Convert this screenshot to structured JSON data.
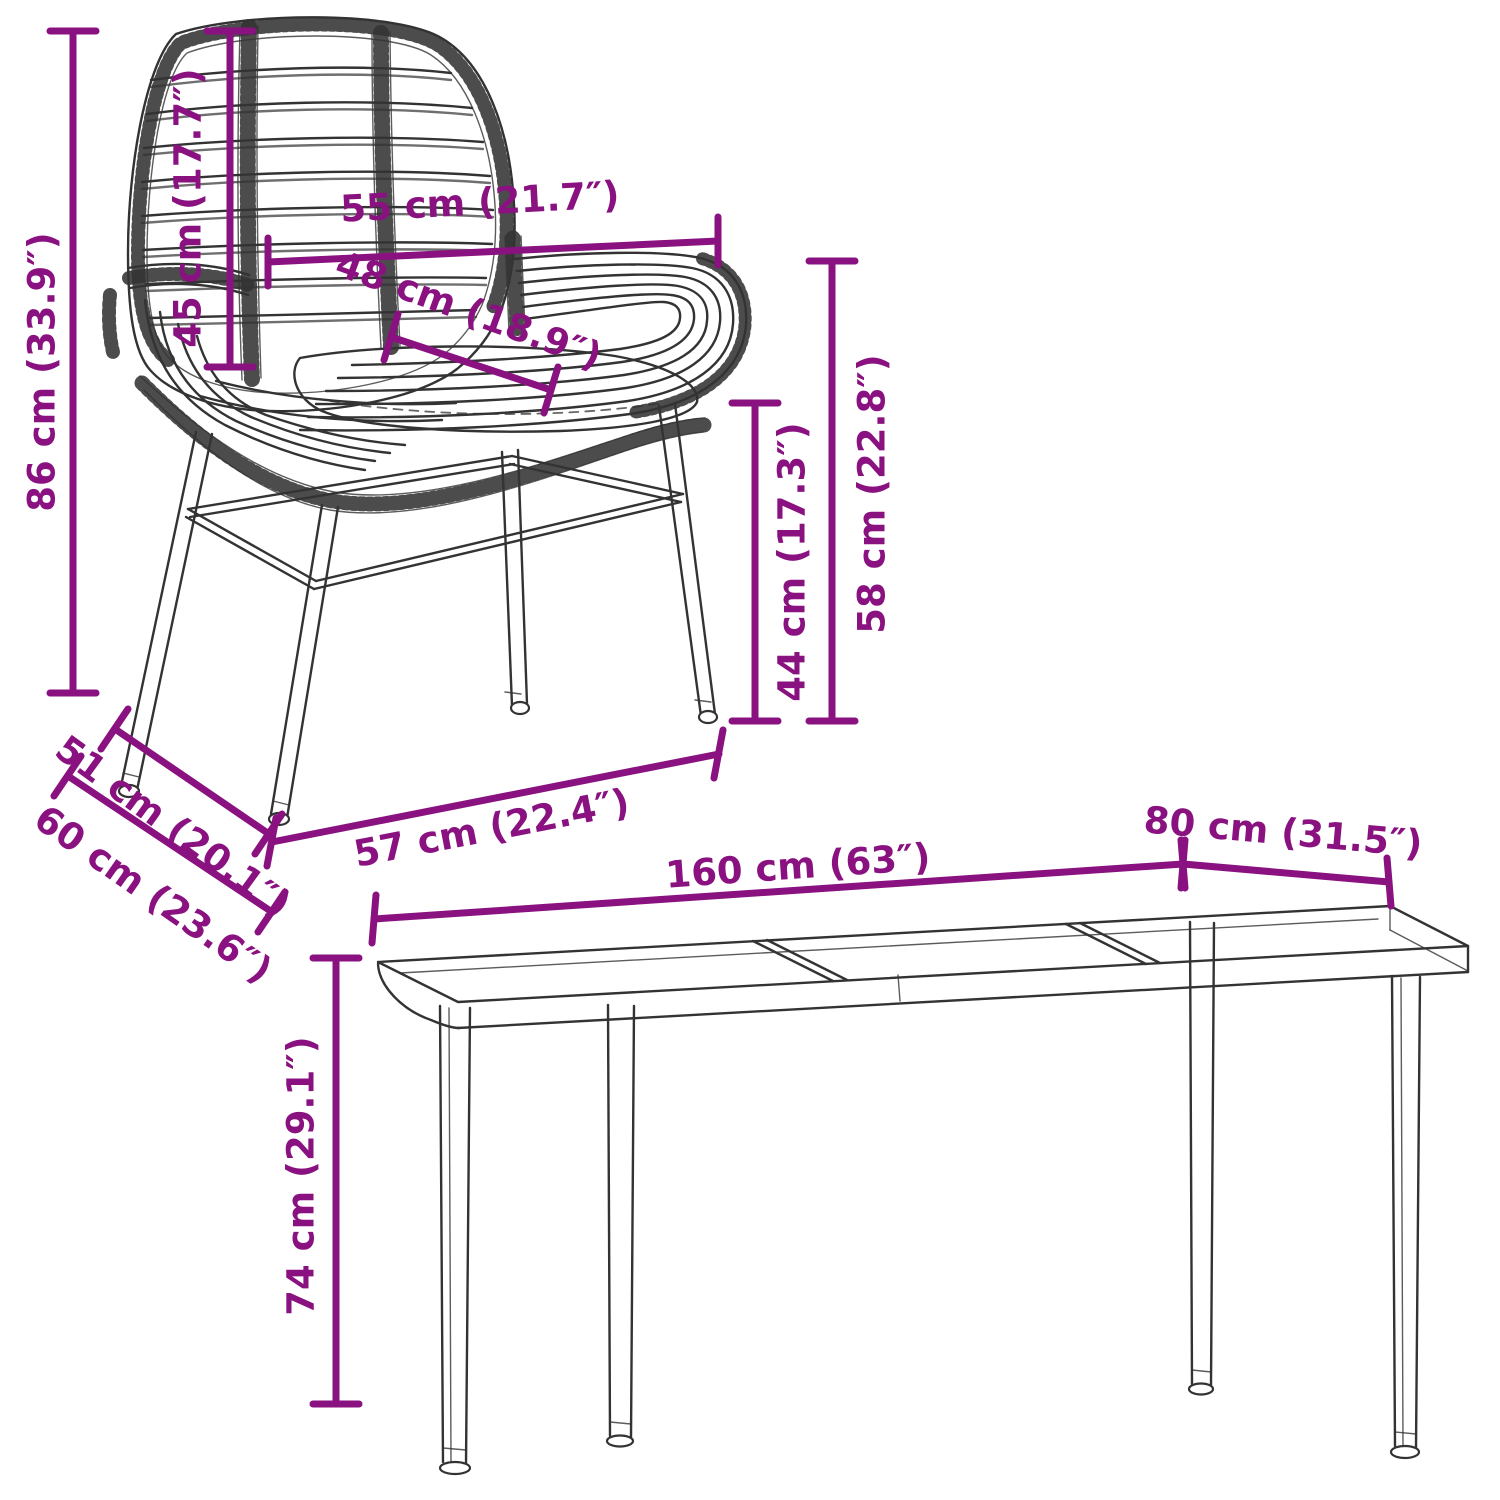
{
  "diagram": {
    "background_color": "#ffffff",
    "accent_color": "#8A1180",
    "line_color": "#333333",
    "chair": {
      "overall_height": "86 cm (33.9″)",
      "backrest_height": "45 cm (17.7″)",
      "top_width": "55 cm (21.7″)",
      "seat_width": "48 cm (18.9″)",
      "seat_height": "44 cm (17.3″)",
      "armrest_height": "58 cm (22.8″)",
      "seat_depth": "51 cm (20.1″)",
      "total_depth": "60 cm (23.6″)",
      "base_width": "57 cm (22.4″)"
    },
    "table": {
      "length": "160 cm (63″)",
      "width": "80 cm (31.5″)",
      "height": "74 cm (29.1″)"
    }
  }
}
